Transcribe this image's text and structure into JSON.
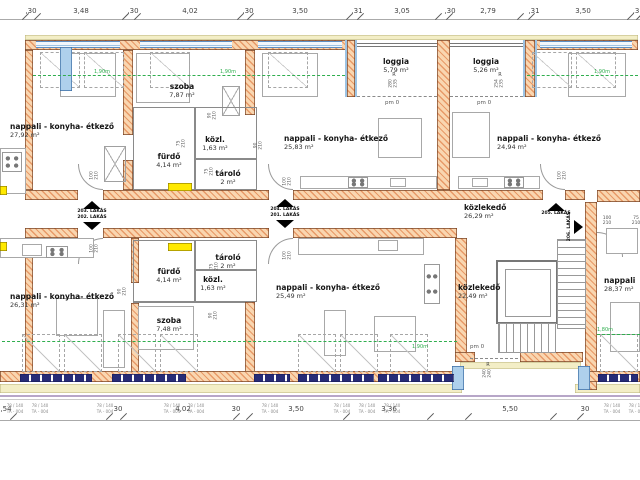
{
  "colors": {
    "wall_fill": "#f9d6b0",
    "wall_hatch": "#e89a68",
    "wall_edge": "#7b4526",
    "window_blue": "#aed0ec",
    "window_navy": "#272c77",
    "band_cream": "#f3eec6",
    "threshold_yellow": "#ffe900",
    "green_dim": "#2fae4e",
    "text": "#222222"
  },
  "r_mark": "R",
  "dims_top": {
    "labels": [
      {
        "t": ",30",
        "x": 31
      },
      {
        "t": "3,48",
        "x": 81
      },
      {
        "t": ",30",
        "x": 133
      },
      {
        "t": "4,02",
        "x": 190
      },
      {
        "t": ",30",
        "x": 248
      },
      {
        "t": "3,50",
        "x": 300
      },
      {
        "t": ",31",
        "x": 357
      },
      {
        "t": "3,05",
        "x": 402
      },
      {
        "t": ",30",
        "x": 450
      },
      {
        "t": "2,79",
        "x": 488
      },
      {
        "t": ",31",
        "x": 534
      },
      {
        "t": "3,50",
        "x": 583
      },
      {
        "t": ",3",
        "x": 636
      }
    ],
    "ticks": [
      25,
      37,
      125,
      137,
      240,
      250,
      349,
      360,
      438,
      449,
      520,
      531,
      630,
      639
    ]
  },
  "dims_bottom": {
    "labels": [
      {
        "t": ",54",
        "x": 6
      },
      {
        "t": "30",
        "x": 118
      },
      {
        "t": "4,02",
        "x": 183
      },
      {
        "t": "30",
        "x": 236
      },
      {
        "t": "3,50",
        "x": 296
      },
      {
        "t": "3,36",
        "x": 389
      },
      {
        "t": "5,50",
        "x": 510
      },
      {
        "t": "30",
        "x": 585
      }
    ],
    "ticks": [
      13,
      109,
      123,
      236,
      249,
      346,
      430,
      468,
      553,
      580
    ]
  },
  "rooms": [
    {
      "name": "nappali - konyha- étkező",
      "area": "27,92 m²",
      "x": 10,
      "y": 123,
      "w": 120,
      "align": "left"
    },
    {
      "name": "szoba",
      "area": "7,87 m²",
      "x": 154,
      "y": 83,
      "w": 56,
      "align": "center"
    },
    {
      "name": "fürdő",
      "area": "4,14 m²",
      "x": 146,
      "y": 153,
      "w": 46,
      "align": "center"
    },
    {
      "name": "közl.",
      "area": "1,63 m²",
      "x": 193,
      "y": 136,
      "w": 44,
      "align": "center"
    },
    {
      "name": "tároló",
      "area": "2 m²",
      "x": 206,
      "y": 170,
      "w": 44,
      "align": "center"
    },
    {
      "name": "nappali - konyha- étkező",
      "area": "25,83 m²",
      "x": 284,
      "y": 135,
      "w": 120,
      "align": "left"
    },
    {
      "name": "loggia",
      "area": "5,79 m²",
      "x": 368,
      "y": 58,
      "w": 56,
      "align": "center"
    },
    {
      "name": "loggia",
      "area": "5,26 m²",
      "x": 458,
      "y": 58,
      "w": 56,
      "align": "center"
    },
    {
      "name": "nappali - konyha- étkező",
      "area": "24,94 m²",
      "x": 497,
      "y": 135,
      "w": 125,
      "align": "left"
    },
    {
      "name": "közlekedő",
      "area": "26,29 m²",
      "x": 464,
      "y": 204,
      "w": 70,
      "align": "left"
    },
    {
      "name": "nappali - konyha- étkező",
      "area": "26,31 m²",
      "x": 10,
      "y": 293,
      "w": 120,
      "align": "left"
    },
    {
      "name": "fürdő",
      "area": "4,14 m²",
      "x": 146,
      "y": 268,
      "w": 46,
      "align": "center"
    },
    {
      "name": "tároló",
      "area": "2 m²",
      "x": 206,
      "y": 254,
      "w": 44,
      "align": "center"
    },
    {
      "name": "közl.",
      "area": "1,63 m²",
      "x": 191,
      "y": 276,
      "w": 44,
      "align": "center"
    },
    {
      "name": "szoba",
      "area": "7,48 m²",
      "x": 143,
      "y": 317,
      "w": 52,
      "align": "center"
    },
    {
      "name": "nappali - konyha- étkező",
      "area": "25,49 m²",
      "x": 276,
      "y": 284,
      "w": 120,
      "align": "left"
    },
    {
      "name": "közlekedő",
      "area": "22,49 m²",
      "x": 458,
      "y": 284,
      "w": 64,
      "align": "left"
    },
    {
      "name": "nappali",
      "area": "28,37 m²",
      "x": 604,
      "y": 277,
      "w": 40,
      "align": "left"
    }
  ],
  "apartment_doors": [
    {
      "type": "double",
      "top": "203. LAKÁS",
      "bottom": "202. LAKÁS",
      "x": 70,
      "y": 201
    },
    {
      "type": "double",
      "top": "204. LAKÁS",
      "bottom": "201. LAKÁS",
      "x": 263,
      "y": 199
    },
    {
      "type": "up",
      "label": "205. LAKÁS",
      "x": 534,
      "y": 203
    },
    {
      "type": "side",
      "label": "206. LAKÁS",
      "x": 567,
      "y": 212
    }
  ],
  "door_sizes": [
    {
      "a": "100",
      "b": "210",
      "x": 88,
      "y": 170,
      "v": true
    },
    {
      "a": "90",
      "b": "210",
      "x": 206,
      "y": 110,
      "v": true
    },
    {
      "a": "75",
      "b": "210",
      "x": 175,
      "y": 138,
      "v": true
    },
    {
      "a": "90",
      "b": "210",
      "x": 252,
      "y": 140,
      "v": true
    },
    {
      "a": "75",
      "b": "210",
      "x": 203,
      "y": 166,
      "v": true
    },
    {
      "a": "100",
      "b": "210",
      "x": 281,
      "y": 176,
      "v": true
    },
    {
      "a": "100",
      "b": "210",
      "x": 556,
      "y": 170,
      "v": true
    },
    {
      "a": "100",
      "b": "210",
      "x": 600,
      "y": 216,
      "v": false
    },
    {
      "a": "75",
      "b": "210",
      "x": 629,
      "y": 216,
      "v": false
    },
    {
      "a": "100",
      "b": "210",
      "x": 88,
      "y": 243,
      "v": true
    },
    {
      "a": "90",
      "b": "210",
      "x": 116,
      "y": 286,
      "v": true
    },
    {
      "a": "75",
      "b": "210",
      "x": 208,
      "y": 261,
      "v": true
    },
    {
      "a": "90",
      "b": "210",
      "x": 207,
      "y": 310,
      "v": true
    },
    {
      "a": "100",
      "b": "210",
      "x": 281,
      "y": 250,
      "v": true
    }
  ],
  "window_sizes": [
    {
      "a": "280",
      "b": "235",
      "x": 388,
      "y": 72
    },
    {
      "a": "254",
      "b": "235",
      "x": 494,
      "y": 72
    },
    {
      "a": "240",
      "b": "240",
      "x": 482,
      "y": 362
    }
  ],
  "pm_labels": [
    {
      "t": "pm 0",
      "x": 385,
      "y": 100
    },
    {
      "t": "pm 0",
      "x": 477,
      "y": 100
    },
    {
      "t": "pm 0",
      "x": 470,
      "y": 344
    }
  ],
  "green_labels": [
    {
      "t": "1,90m",
      "x": 94,
      "y": 69
    },
    {
      "t": "1,90m",
      "x": 220,
      "y": 69
    },
    {
      "t": "1,90m",
      "x": 594,
      "y": 69
    },
    {
      "t": "1,90m",
      "x": 412,
      "y": 344
    },
    {
      "t": "1,80m",
      "x": 597,
      "y": 327
    }
  ],
  "window_tags": {
    "line1": "78 / 140",
    "line2": "TA - 004",
    "positions": [
      15,
      40,
      105,
      172,
      196,
      270,
      342,
      367,
      392,
      612,
      637
    ]
  }
}
